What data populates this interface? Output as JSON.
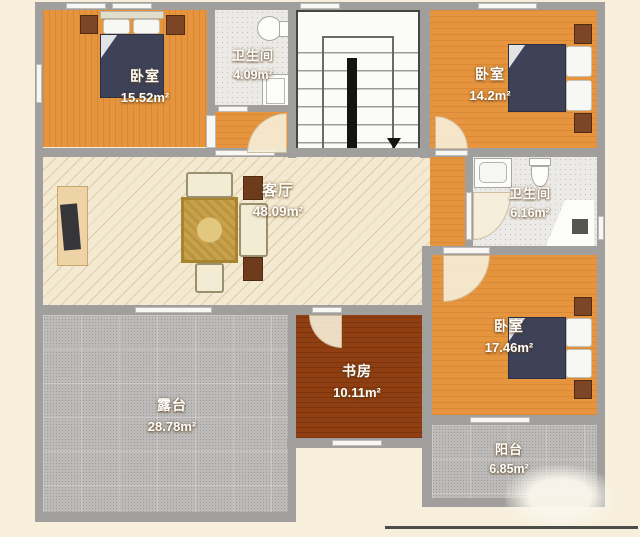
{
  "canvas": {
    "width": 640,
    "height": 537
  },
  "colors": {
    "background": "#f7efdc",
    "wall": "#a09f9d",
    "wood_floor": "#e6953e",
    "living_floor": "#f4ead1",
    "study_floor": "#8f3f12",
    "terrace_floor": "#bcbbb9",
    "tile_floor": "#eceae6",
    "bed_blanket": "#3d4258",
    "furniture_brown": "#6e3c1c",
    "rug": "#c8a14b"
  },
  "rooms": [
    {
      "id": "bedroom-top-left",
      "name": "卧室",
      "area": "15.52m²"
    },
    {
      "id": "bathroom-top",
      "name": "卫生间",
      "area": "4.09m²"
    },
    {
      "id": "bedroom-top-right",
      "name": "卧室",
      "area": "14.2m²"
    },
    {
      "id": "living-room",
      "name": "客厅",
      "area": "48.09m²"
    },
    {
      "id": "bathroom-right",
      "name": "卫生间",
      "area": "6.16m²"
    },
    {
      "id": "bedroom-bottom-right",
      "name": "卧室",
      "area": "17.46m²"
    },
    {
      "id": "study",
      "name": "书房",
      "area": "10.11m²"
    },
    {
      "id": "terrace",
      "name": "露台",
      "area": "28.78m²"
    },
    {
      "id": "balcony",
      "name": "阳台",
      "area": "6.85m²"
    }
  ],
  "fixtures": [
    "double-bed",
    "nightstand",
    "pillow",
    "sofa",
    "armchair",
    "rug",
    "tv-console",
    "coffee-table",
    "toilet",
    "sink",
    "shower",
    "staircase",
    "down-arrow"
  ]
}
